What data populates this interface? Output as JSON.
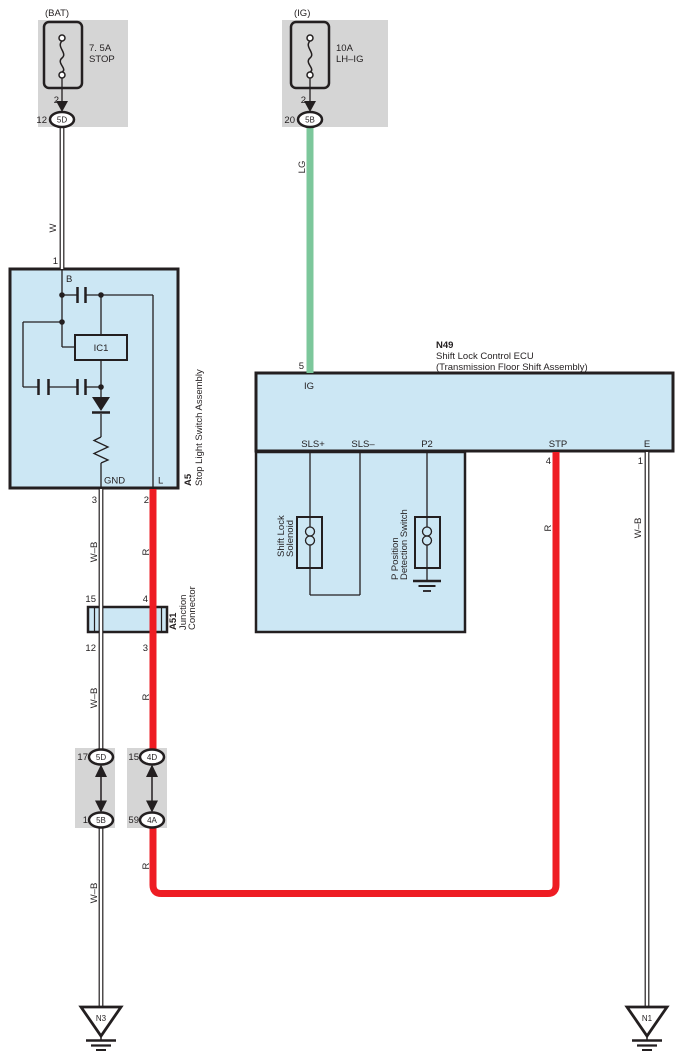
{
  "colors": {
    "component_fill": "#cce7f4",
    "shield_fill": "#d5d5d5",
    "wire_red": "#ee1c23",
    "wire_green": "#7cc79b",
    "ink": "#231f20"
  },
  "fuses": {
    "bat": {
      "header": "(BAT)",
      "rating": "7. 5A",
      "name": "STOP",
      "pin": "2",
      "conn_no": "12",
      "conn_code": "5D"
    },
    "ig": {
      "header": "(IG)",
      "rating": "10A",
      "name": "LH–IG",
      "pin": "2",
      "conn_no": "20",
      "conn_code": "5B"
    }
  },
  "wires": {
    "white": "W",
    "light_green": "LG",
    "white_black": "W–B",
    "red": "R"
  },
  "a5": {
    "id": "A5",
    "name": "Stop Light Switch Assembly",
    "pin_top": "1",
    "terminal_b": "B",
    "ic": "IC1",
    "terminal_gnd": "GND",
    "terminal_l": "L",
    "pin_gnd": "3",
    "pin_l": "2"
  },
  "a51": {
    "id": "A51",
    "name_line1": "Junction",
    "name_line2": "Connector",
    "pin_top_left": "15",
    "pin_top_right": "4",
    "pin_bottom_left": "12",
    "pin_bottom_right": "3"
  },
  "connectors": {
    "left": {
      "top_no": "17",
      "top_code": "5D",
      "bottom_no": "1",
      "bottom_code": "5B"
    },
    "right": {
      "top_no": "15",
      "top_code": "4D",
      "bottom_no": "59",
      "bottom_code": "4A"
    }
  },
  "ecu": {
    "id": "N49",
    "name_line1": "Shift Lock Control ECU",
    "name_line2": "(Transmission Floor Shift Assembly)",
    "pin_ig": "5",
    "terminal_ig": "IG",
    "terminal_sls_plus": "SLS+",
    "terminal_sls_minus": "SLS–",
    "terminal_p2": "P2",
    "terminal_stp": "STP",
    "terminal_e": "E",
    "pin_stp": "4",
    "pin_e": "1",
    "solenoid_line1": "Shift Lock",
    "solenoid_line2": "Solenoid",
    "pswitch_line1": "P Position",
    "pswitch_line2": "Detection Switch"
  },
  "grounds": {
    "left": "N3",
    "right": "N1"
  }
}
